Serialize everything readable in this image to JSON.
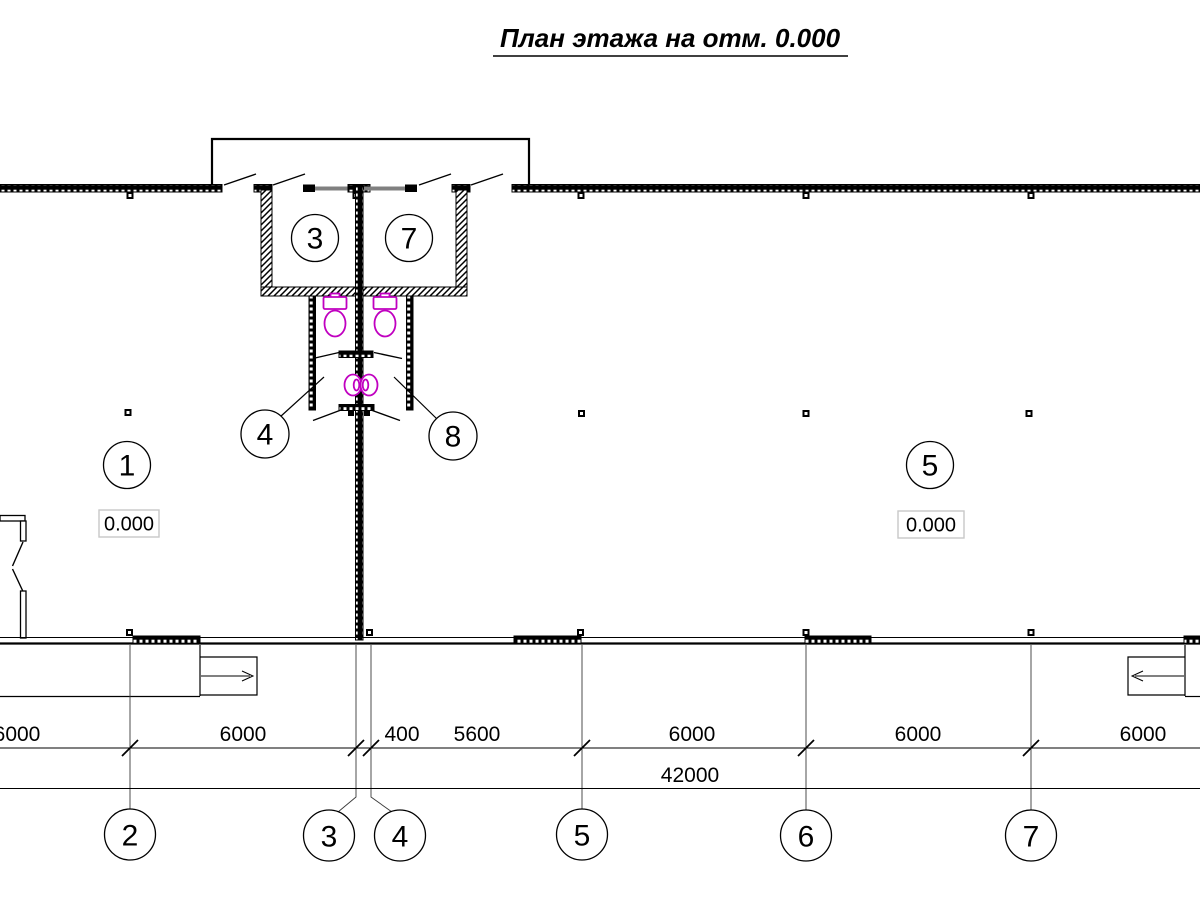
{
  "drawing": {
    "title": "План этажа на отм. 0.000",
    "type": "floor-plan"
  },
  "labels": {
    "wc_left": "3",
    "wc_right": "7",
    "stall_left": "4",
    "stall_right": "8",
    "room_left": "1",
    "room_right": "5",
    "elev_left": "0.000",
    "elev_right": "0.000"
  },
  "dims": {
    "row": [
      "6000",
      "6000",
      "400",
      "5600",
      "6000",
      "6000",
      "6000"
    ],
    "total": "42000"
  },
  "axes": {
    "list": [
      "2",
      "3",
      "4",
      "5",
      "6",
      "7"
    ]
  },
  "colors": {
    "line_black": "#000000",
    "fixture_magenta": "#C000C0",
    "glazing_gray": "#808080"
  }
}
